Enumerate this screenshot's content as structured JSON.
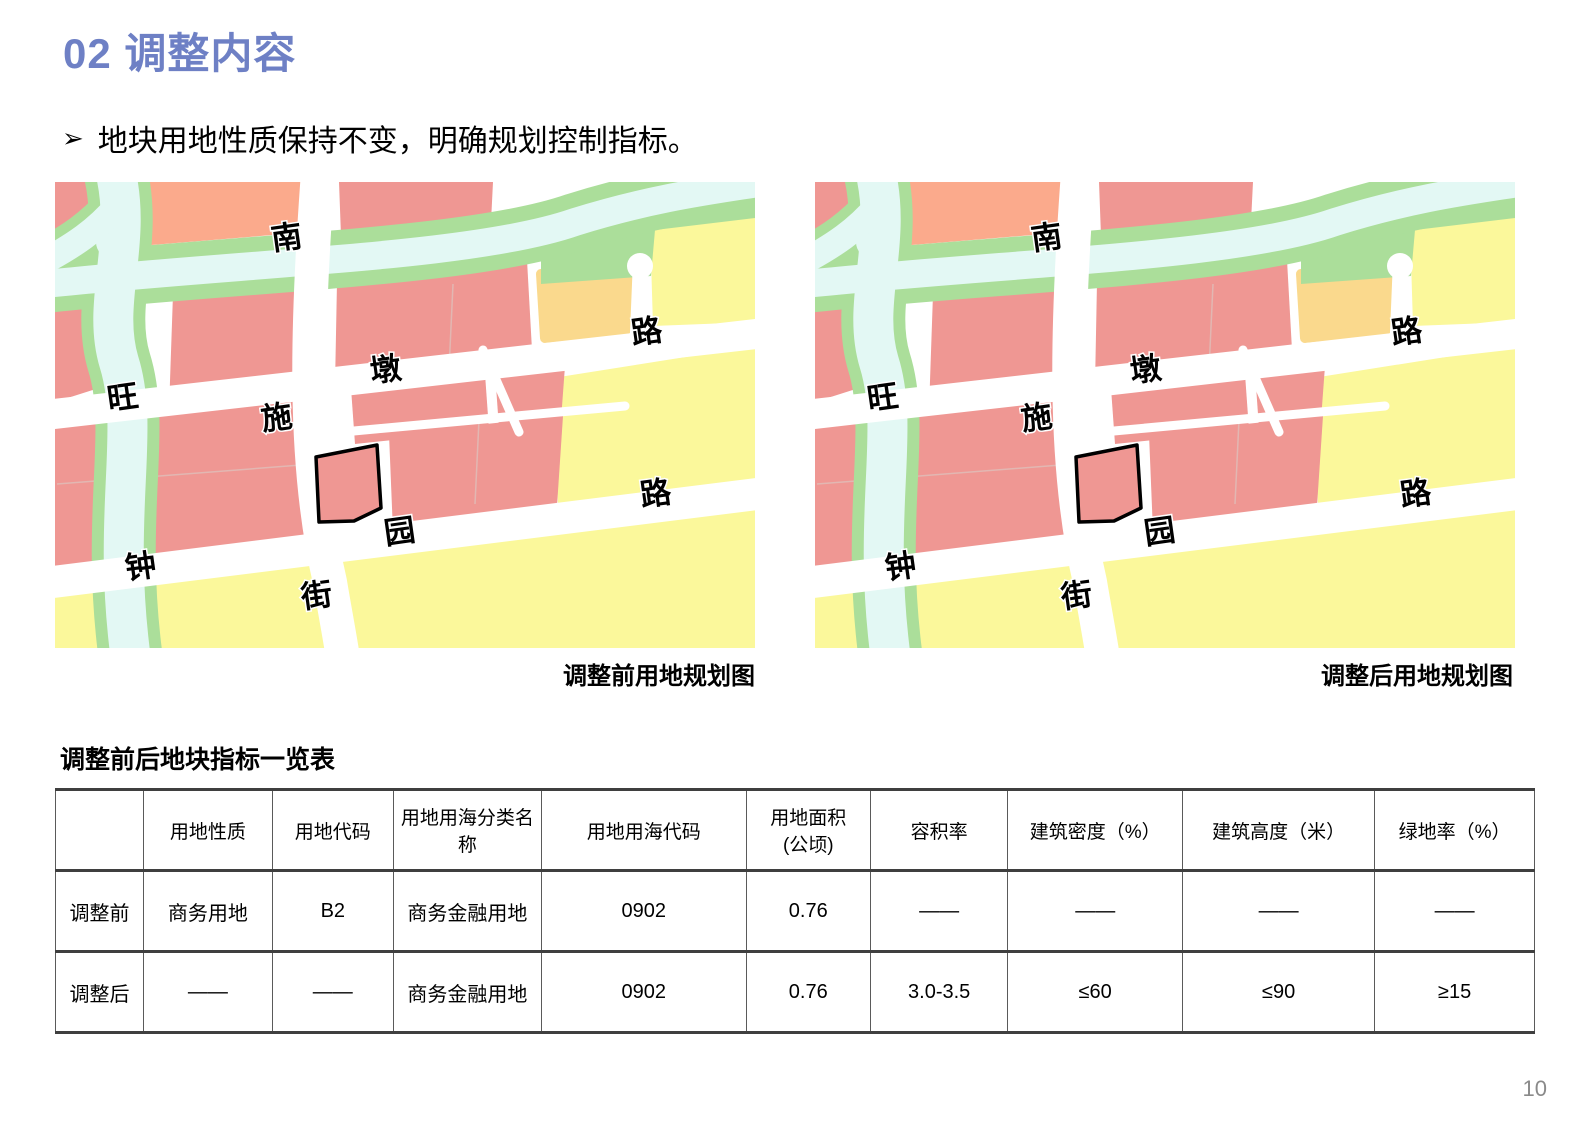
{
  "page": {
    "title": "02 调整内容",
    "bullet_marker": "➢",
    "bullet_text": "地块用地性质保持不变，明确规划控制指标。",
    "page_number": "10"
  },
  "maps": {
    "before_caption": "调整前用地规划图",
    "after_caption": "调整后用地规划图",
    "road_labels": {
      "nan": "南",
      "wang": "旺",
      "dun": "墩",
      "lu_upper": "路",
      "shi": "施",
      "yuan": "园",
      "lu_lower": "路",
      "zhong": "钟",
      "jie": "街"
    },
    "colors": {
      "pink": "#EF9793",
      "peach": "#FBAA8C",
      "green": "#ABDE9A",
      "water": "#E3F8F4",
      "yellow": "#FBF89B",
      "orange": "#FAD98D",
      "road": "#FFFFFF",
      "parcel_outline": "#000000"
    }
  },
  "table": {
    "title": "调整前后地块指标一览表",
    "headers": [
      "",
      "用地性质",
      "用地代码",
      "用地用海分类名称",
      "用地用海代码",
      "用地面积\n(公顷)",
      "容积率",
      "建筑密度（%）",
      "建筑高度（米）",
      "绿地率（%）"
    ],
    "rows": [
      {
        "label": "调整前",
        "cells": [
          "商务用地",
          "B2",
          "商务金融用地",
          "0902",
          "0.76",
          "——",
          "——",
          "——",
          "——"
        ]
      },
      {
        "label": "调整后",
        "cells": [
          "——",
          "——",
          "商务金融用地",
          "0902",
          "0.76",
          "3.0-3.5",
          "≤60",
          "≤90",
          "≥15"
        ]
      }
    ]
  }
}
